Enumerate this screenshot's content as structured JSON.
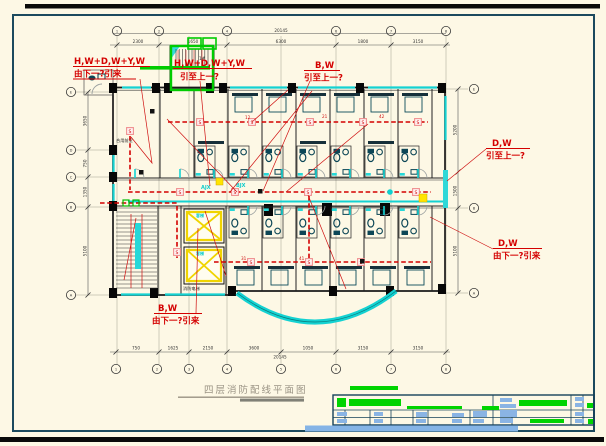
{
  "title": {
    "text": "四层消防配线平面图"
  },
  "annotations": {
    "a1": {
      "l1": "H,W+D,W+Y,W",
      "l2": "由下一?引来"
    },
    "a2": {
      "l1": "H,W+D,W+Y,W",
      "l2": "引至上一?"
    },
    "a3": {
      "l1": "B,W",
      "l2": "引至上一?"
    },
    "a4": {
      "l1": "D,W",
      "l2": "引至上一?"
    },
    "a5": {
      "l1": "D,W",
      "l2": "由下一?引来"
    },
    "a6": {
      "l1": "B,W",
      "l2": "由下一?引来"
    }
  },
  "labels": {
    "s": "S",
    "ajx": "AJX",
    "bjx": "BJX",
    "lobby": "合用前室",
    "elevator": "客梯",
    "fire_elevator": "消防电梯",
    "stair_no": "1#"
  },
  "circuits": {
    "c1": "12",
    "c2": "21",
    "c3": "42",
    "c4": "31",
    "c5": "41"
  },
  "dims": {
    "top": [
      "2300",
      "1650",
      "6300",
      "1800",
      "3150"
    ],
    "top_total": "20145",
    "bottom": [
      "750",
      "1625",
      "2150",
      "3600",
      "1050",
      "3150",
      "3150"
    ],
    "bottom_total": "20145",
    "left": [
      "3650",
      "750",
      "1350",
      "5100"
    ],
    "right": [
      "5200",
      "1500",
      "5100"
    ]
  },
  "axes": {
    "top": [
      "1",
      "2",
      "4",
      "6",
      "7",
      "8"
    ],
    "bottom": [
      "1",
      "2",
      "3",
      "4",
      "5",
      "6",
      "7",
      "8"
    ],
    "left": [
      "E",
      "D",
      "C",
      "B",
      "A"
    ],
    "right": [
      "E",
      "B",
      "A"
    ]
  },
  "colors": {
    "background": "#fdf8e5",
    "frame": "#1c4a5e",
    "wall": "#1a1a1a",
    "annotation_red": "#d40000",
    "detector_pink": "#ef8f8f",
    "pipe_cyan": "#14d2d2",
    "stair_green": "#00cc00",
    "elevator_yellow": "#f0d400",
    "titleblock_blue": "#8ab4e4",
    "title_gray": "#9a9384"
  }
}
